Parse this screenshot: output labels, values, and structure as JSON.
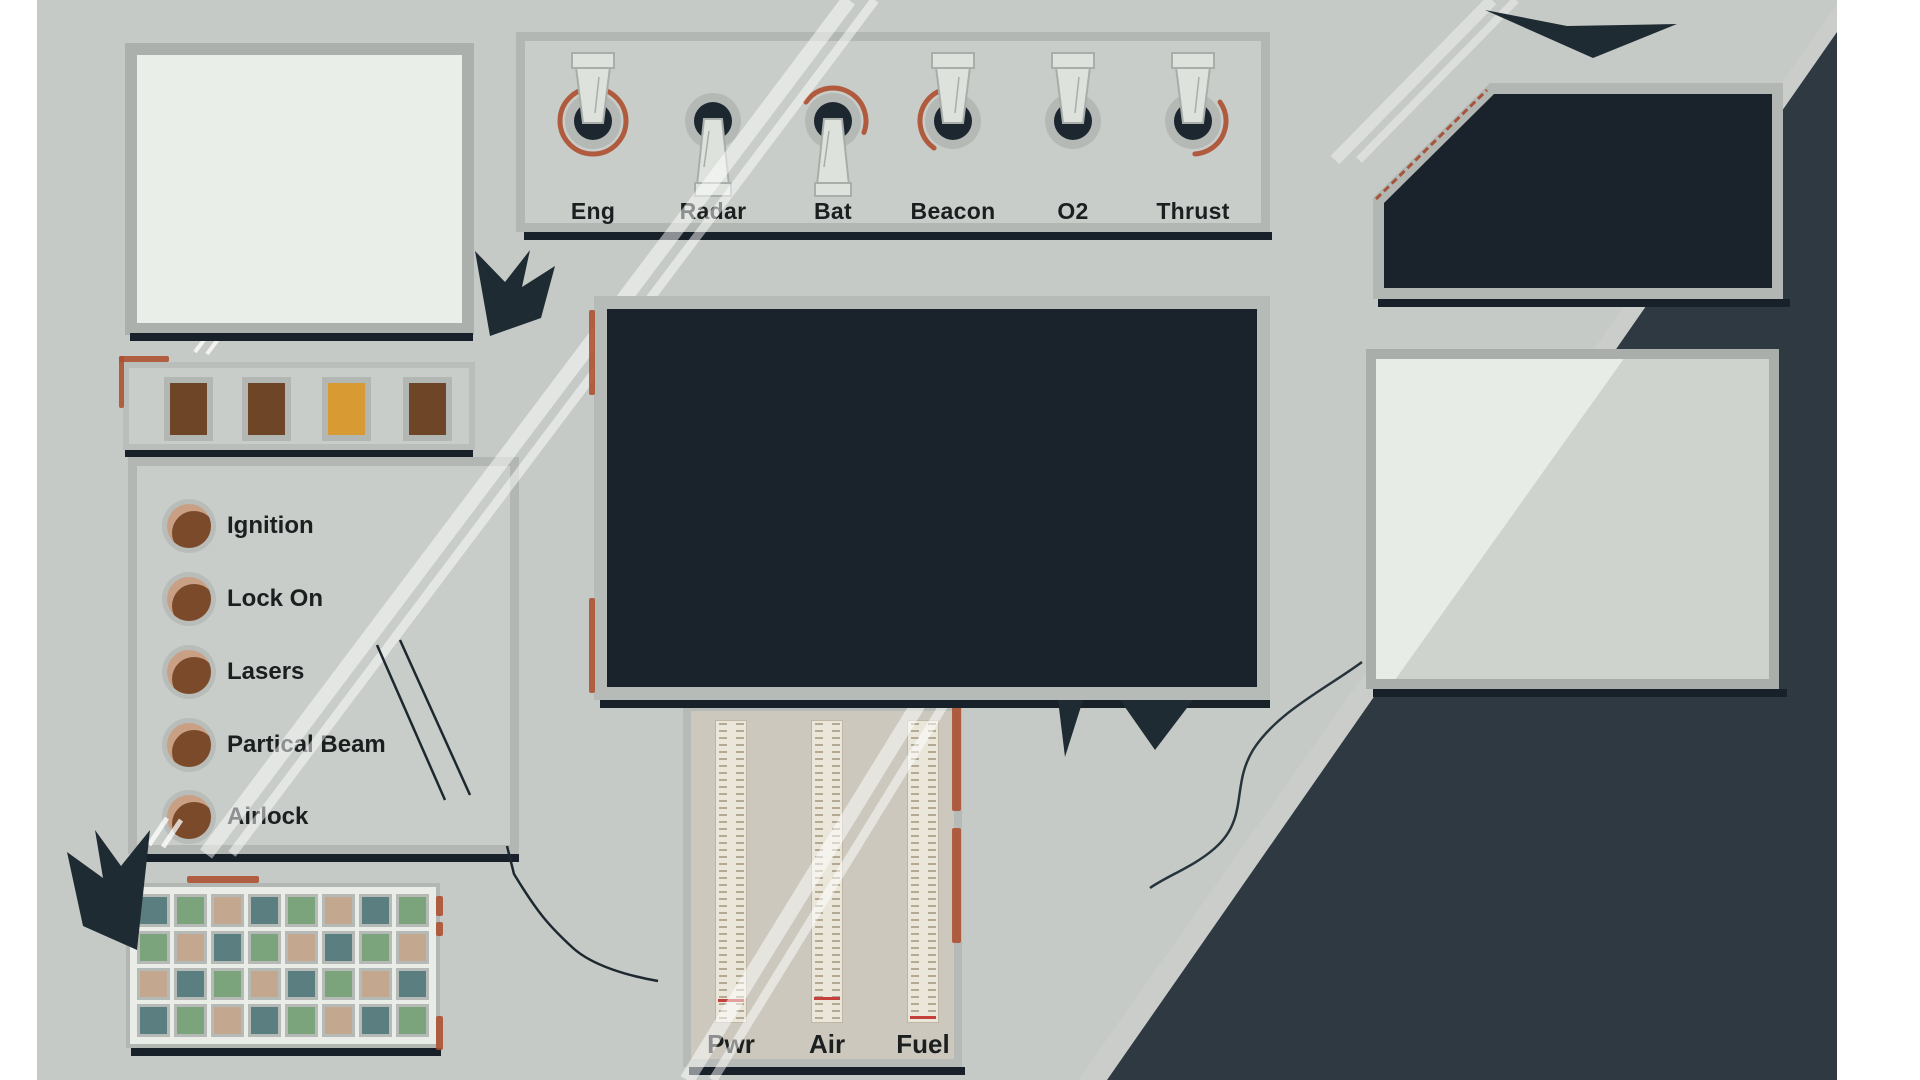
{
  "colors": {
    "background": "#c6cac6",
    "dark_navy": "#1f2b33",
    "screen_dark": "#1a222b",
    "panel_gray": "#c9cdc9",
    "panel_border": "#b2b7b3",
    "screen_light": "#e9eee8",
    "rust_accent": "#ad4f2f",
    "gauge_beige": "#ccc8bd",
    "gauge_strip": "#eae6da",
    "gauge_indicator_red": "#c6403b",
    "button_brown": "#6f4527",
    "button_amber": "#d89a33",
    "button_highlight_tan": "#c9a084"
  },
  "switch_panel": {
    "switches": [
      {
        "label": "Eng",
        "state": "up",
        "wear": "full"
      },
      {
        "label": "Radar",
        "state": "down",
        "wear": "none"
      },
      {
        "label": "Bat",
        "state": "down",
        "wear": "top"
      },
      {
        "label": "Beacon",
        "state": "up",
        "wear": "left"
      },
      {
        "label": "O2",
        "state": "up",
        "wear": "none"
      },
      {
        "label": "Thrust",
        "state": "up",
        "wear": "right"
      }
    ]
  },
  "indicator_panel": {
    "buttons": [
      {
        "name": "indicator-1",
        "color": "#6f4527"
      },
      {
        "name": "indicator-2",
        "color": "#6f4527"
      },
      {
        "name": "indicator-3",
        "color": "#d89a33"
      },
      {
        "name": "indicator-4",
        "color": "#6f4527"
      }
    ]
  },
  "control_panel": {
    "buttons": [
      {
        "label": "Ignition"
      },
      {
        "label": "Lock On"
      },
      {
        "label": "Lasers"
      },
      {
        "label": "Partical Beam"
      },
      {
        "label": "Airlock"
      }
    ]
  },
  "keypad": {
    "palette": {
      "teal": "#5b7f81",
      "green": "#7ba37c",
      "tan": "#c3a78f"
    },
    "rows": [
      [
        "teal",
        "green",
        "tan",
        "teal",
        "green",
        "tan",
        "teal",
        "green"
      ],
      [
        "green",
        "tan",
        "teal",
        "green",
        "tan",
        "teal",
        "green",
        "tan"
      ],
      [
        "tan",
        "teal",
        "green",
        "tan",
        "teal",
        "green",
        "tan",
        "teal"
      ],
      [
        "teal",
        "green",
        "tan",
        "teal",
        "green",
        "tan",
        "teal",
        "green"
      ]
    ]
  },
  "gauge_panel": {
    "gauges": [
      {
        "label": "Pwr",
        "indicator_position": 0.917
      },
      {
        "label": "Air",
        "indicator_position": 0.91
      },
      {
        "label": "Fuel",
        "indicator_position": 0.975
      }
    ]
  }
}
